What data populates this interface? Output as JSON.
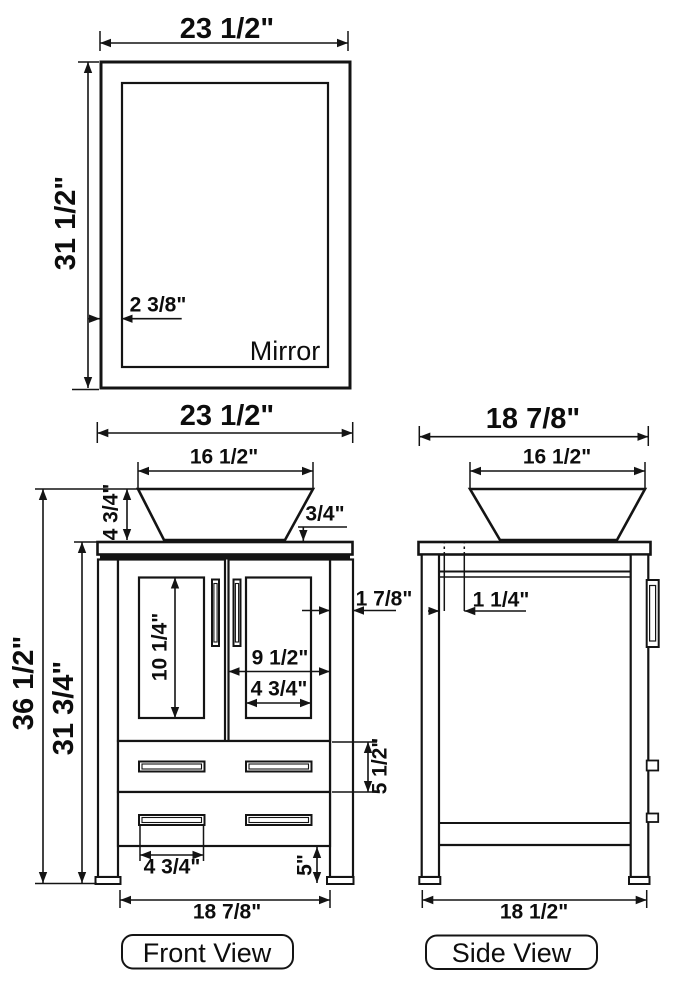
{
  "colors": {
    "line": "#141414",
    "background": "#ffffff",
    "text": "#0d0d0d"
  },
  "mirror": {
    "label": "Mirror",
    "width": "23 1/2\"",
    "height": "31 1/2\"",
    "frame_width": "2 3/8\""
  },
  "front_view": {
    "label": "Front View",
    "overall_width": "23 1/2\"",
    "sink_width": "16 1/2\"",
    "sink_height": "4 3/4\"",
    "countertop_thickness": "3/4\"",
    "overall_height": "36 1/2\"",
    "cabinet_height": "31 3/4\"",
    "door_panel_height": "10 1/4\"",
    "side_stile_width": "1 7/8\"",
    "door_width": "9 1/2\"",
    "door_panel_width": "4 3/4\"",
    "drawer_height": "5 1/2\"",
    "drawer_handle_width": "4 3/4\"",
    "leg_height": "5\"",
    "base_width": "18 7/8\""
  },
  "side_view": {
    "label": "Side View",
    "overall_depth": "18 7/8\"",
    "sink_depth": "16 1/2\"",
    "back_inset": "1 1/4\"",
    "base_depth": "18 1/2\""
  }
}
